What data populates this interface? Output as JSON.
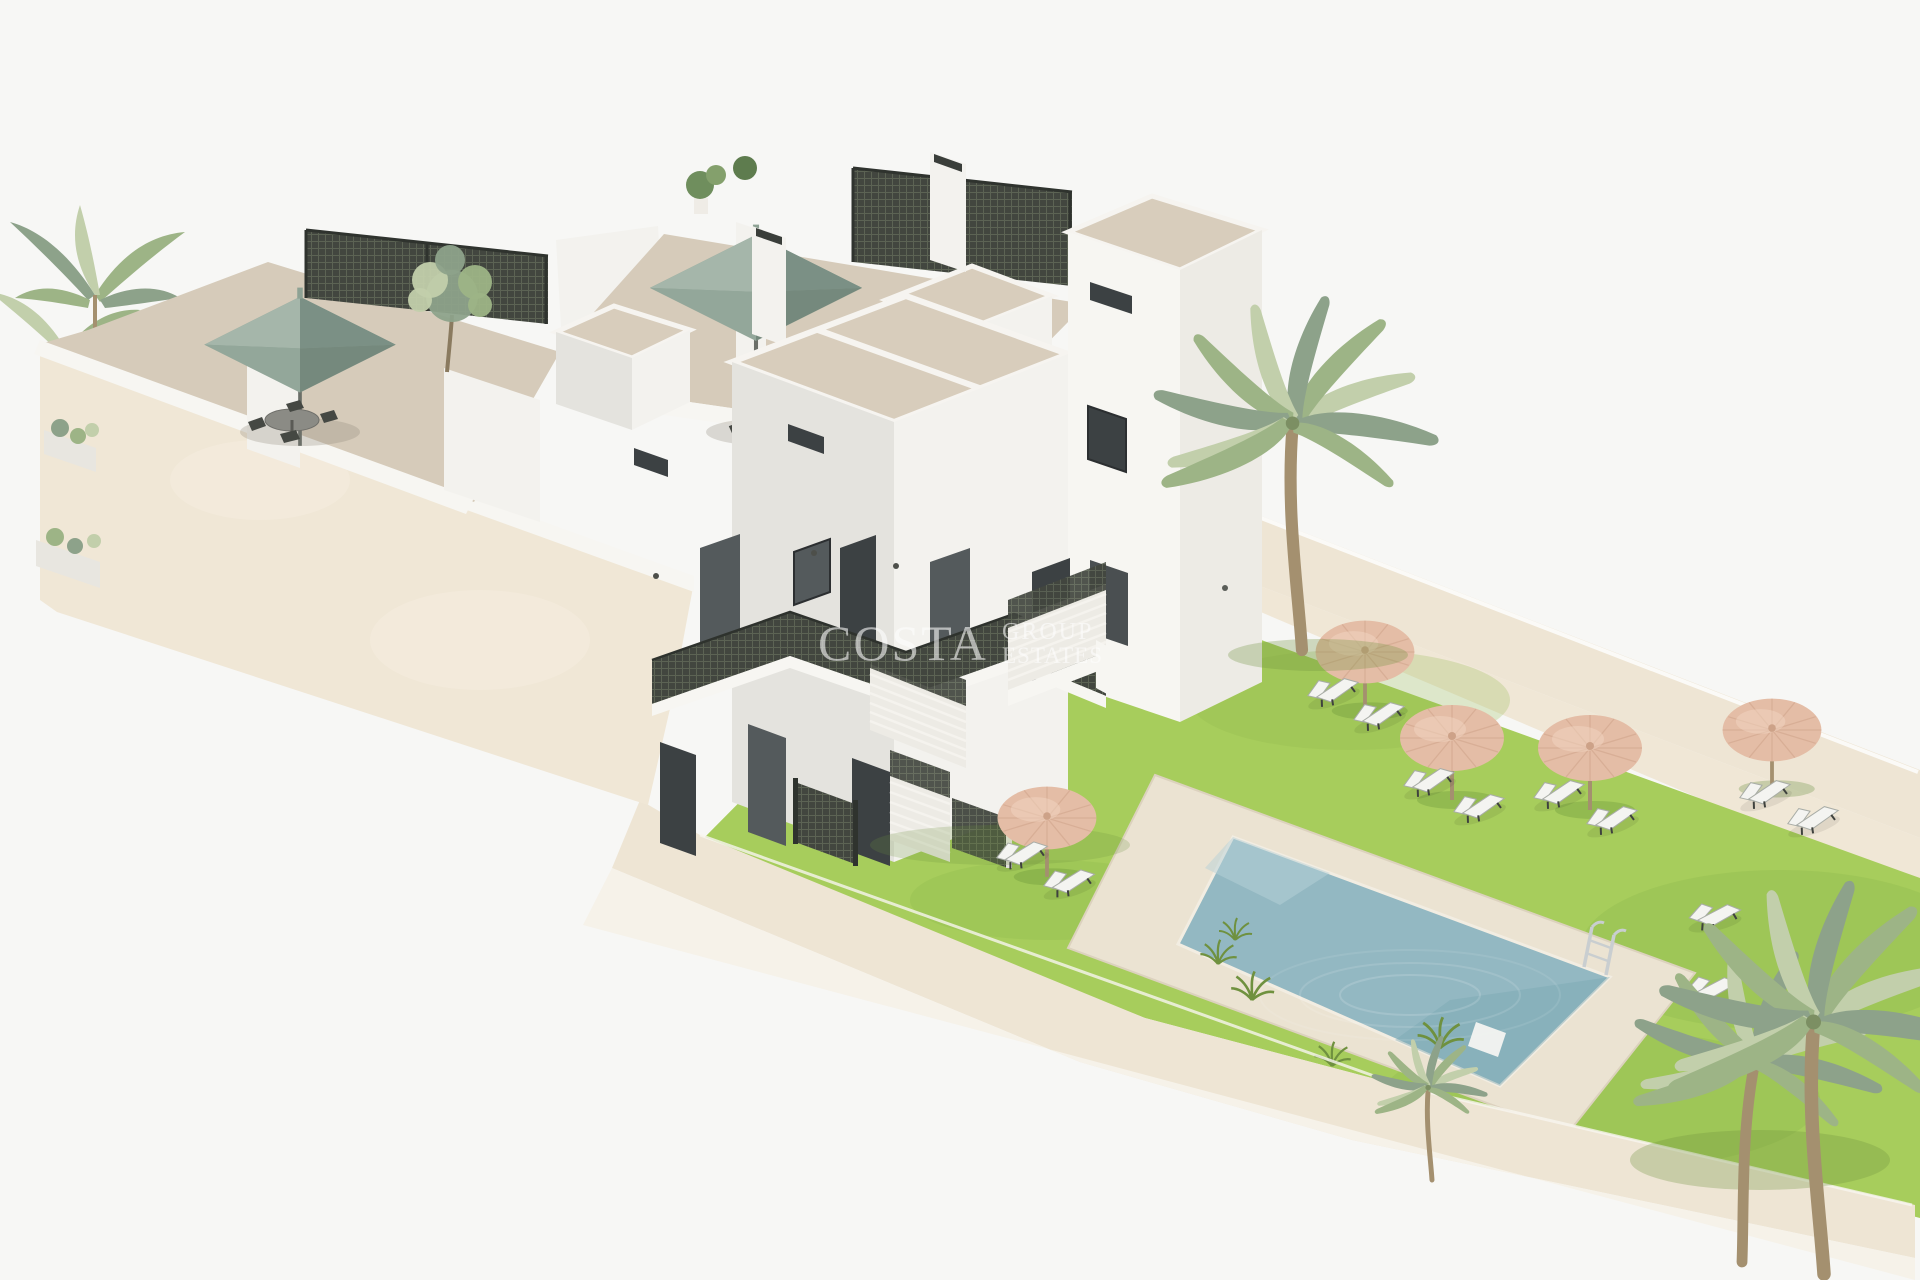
{
  "watermark": {
    "brand": "COSTA",
    "line2": "GROUP",
    "line3": "ESTATES"
  },
  "colors": {
    "background": "#f7f7f5",
    "watermark": "#ffffff",
    "cream_wall": "#f0e7d6",
    "cream_wall_top": "#eee5d4",
    "cream_wall_outer": "#f6f2e9",
    "parapet_white": "#f7f6f2",
    "terrace_floor": "#d6cbba",
    "roof_taupe": "#d8cdbc",
    "building_white": "#f3f2ee",
    "building_bright": "#f7f6f2",
    "building_shade": "#e4e3de",
    "building_shade2": "#edebe5",
    "window_dark": "#3c4143",
    "window_glass": "#545a5c",
    "lattice_dark": "#42463f",
    "lawn": "#a7cd5c",
    "lawn_shade": "#8fb94c",
    "pool_deck": "#ebe3d2",
    "pool_water": "#93b8c2",
    "pool_water_deep": "#7da8b4",
    "straw": "#e4bda6",
    "straw_light": "#f1d3c0",
    "straw_dark": "#cda288",
    "sage": "#8ea294",
    "furniture_white": "#f4f4f1",
    "palm_trunk": "#a4906f",
    "palm_green": "#9db486",
    "palm_green_light": "#c2cfab",
    "palm_green_grey": "#8da28a"
  },
  "scene": {
    "setting": "3D architectural render of a white Mediterranean apartment complex with roof terraces, communal lawn garden and swimming pool",
    "objects": [
      {
        "label": "thatched garden parasols",
        "count": 5
      },
      {
        "label": "green square terrace parasols",
        "count": 2
      },
      {
        "label": "sun loungers",
        "count": 12
      },
      {
        "label": "palm trees",
        "count": 5
      },
      {
        "label": "swimming pool",
        "count": 1
      },
      {
        "label": "pool ladder",
        "count": 1
      },
      {
        "label": "roof terraces",
        "count": 3
      },
      {
        "label": "outdoor dining sets",
        "count": 2
      }
    ]
  }
}
